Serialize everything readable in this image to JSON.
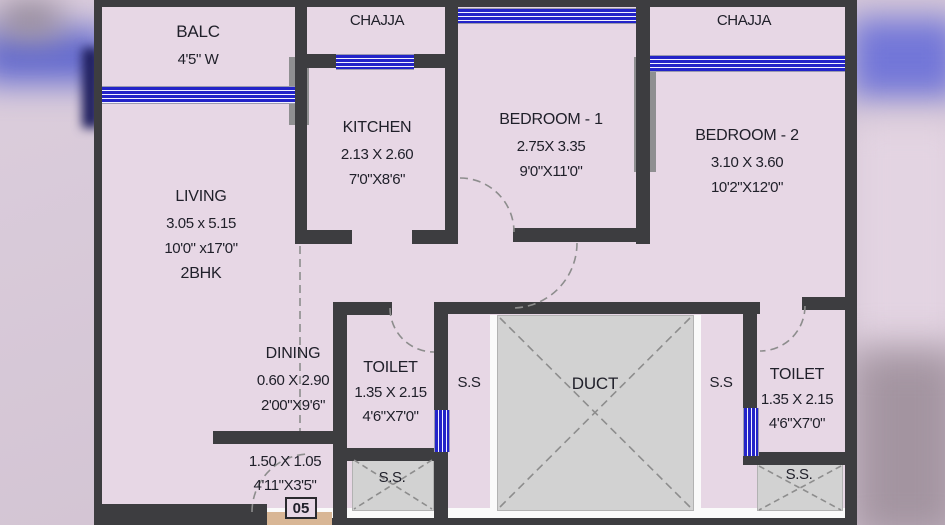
{
  "floor_plan": {
    "unit_number": "05",
    "balcony": {
      "name": "BALC",
      "width": "4'5\" W"
    },
    "chajja_left": "CHAJJA",
    "chajja_right": "CHAJJA",
    "kitchen": {
      "name": "KITCHEN",
      "meters": "2.13 X 2.60",
      "feet": "7'0\"X8'6\""
    },
    "bedroom1": {
      "name": "BEDROOM - 1",
      "meters": "2.75X 3.35",
      "feet": "9'0\"X11'0\""
    },
    "bedroom2": {
      "name": "BEDROOM - 2",
      "meters": "3.10 X 3.60",
      "feet": "10'2\"X12'0\""
    },
    "living": {
      "name": "LIVING",
      "meters": "3.05 x 5.15",
      "feet": "10'0\" x17'0\"",
      "unit_type": "2BHK"
    },
    "dining": {
      "name": "DINING",
      "meters": "0.60 X 2.90",
      "feet": "2'00\"X9'6\""
    },
    "toilet_left": {
      "name": "TOILET",
      "meters": "1.35 X 2.15",
      "feet": "4'6\"X7'0\""
    },
    "toilet_right": {
      "name": "TOILET",
      "meters": "1.35 X 2.15",
      "feet": "4'6\"X7'0\""
    },
    "duct": "DUCT",
    "service_slab_left": "S.S",
    "service_slab_right": "S.S",
    "service_slab_bottom_left": "S.S.",
    "service_slab_bottom_right": "S.S.",
    "entrance": {
      "meters": "1.50 X 1.05",
      "feet": "4'11\"X3'5\""
    },
    "colors": {
      "wall": "#3d3d40",
      "floor": "#e7d7e5",
      "window_blue": "#2323c8",
      "duct_fill": "#d2d2d2",
      "threshold_tan": "#d8b695"
    }
  }
}
